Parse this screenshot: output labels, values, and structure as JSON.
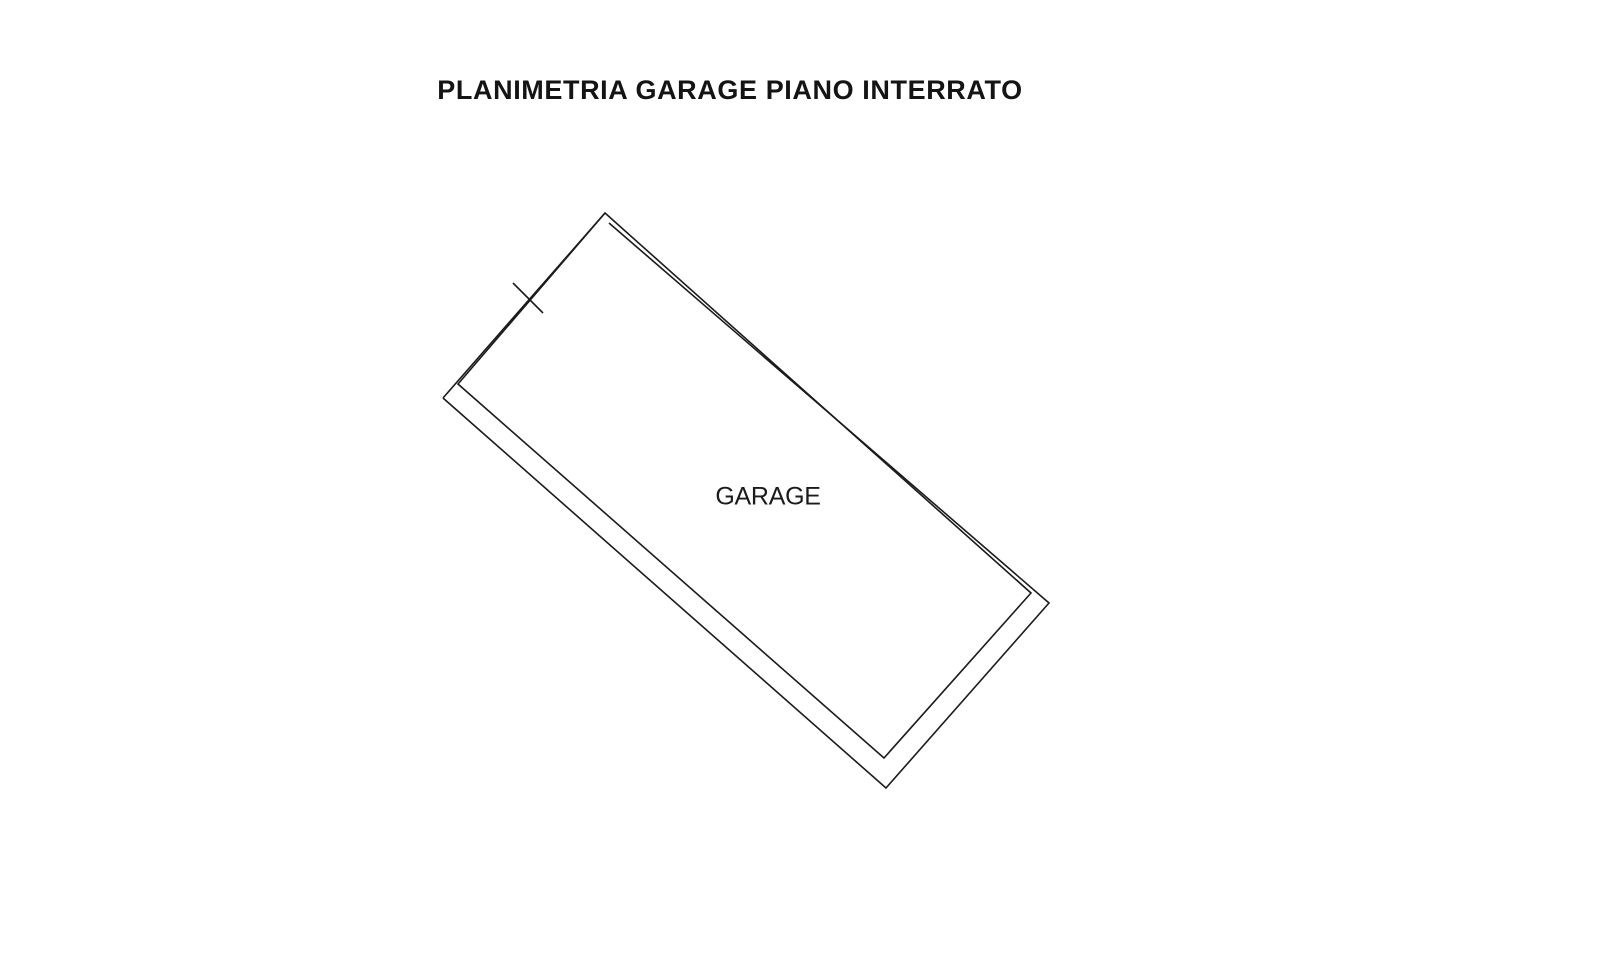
{
  "title": "PLANIMETRIA GARAGE PIANO INTERRATO",
  "plan": {
    "room_label": "GARAGE",
    "line_color": "#1b1b1b",
    "background_color": "#ffffff",
    "inner_outline_points": "605,213 1031,593 884,758 458,384",
    "outer_wall_points": "609,223 1049,603 886,788 443,398",
    "upper_left_wall_points": "605,213 443,398",
    "boundary_tick_points": "513,283 543,313"
  }
}
